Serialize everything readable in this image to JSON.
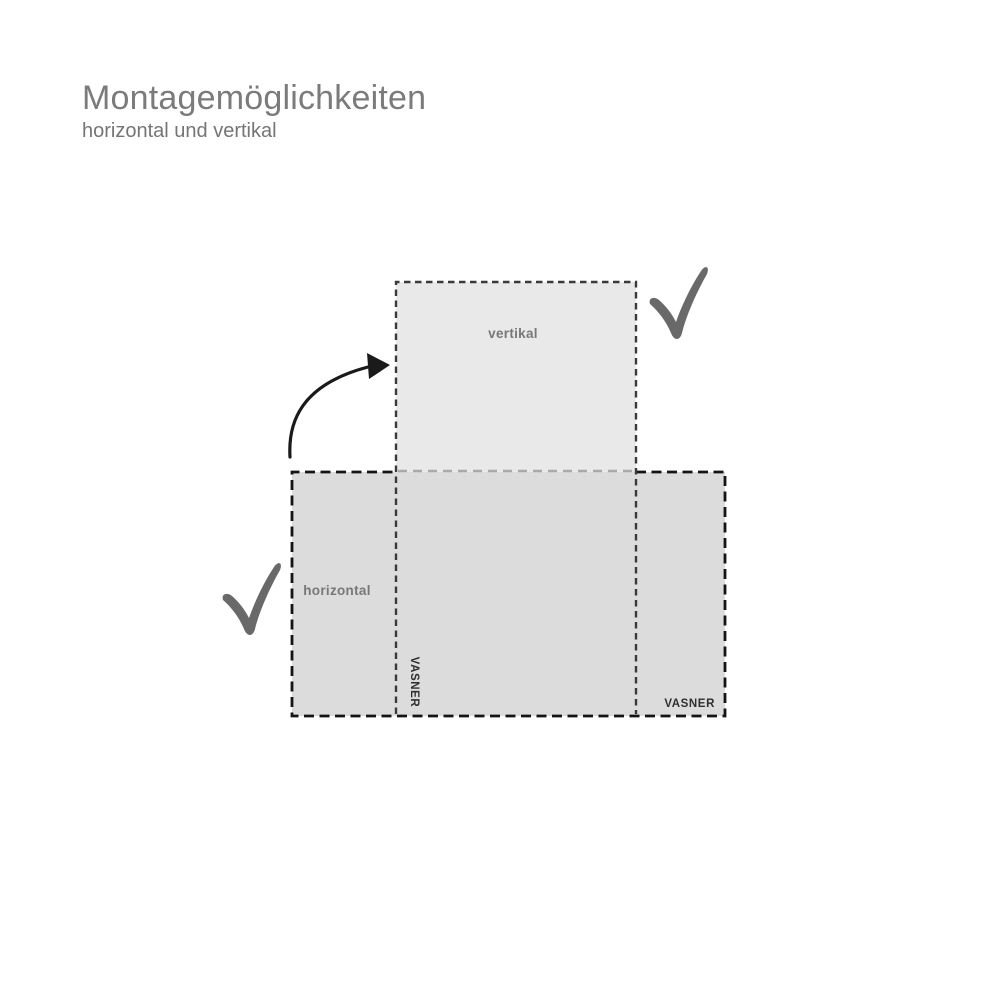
{
  "header": {
    "title": "Montagemöglichkeiten",
    "subtitle": "horizontal und vertikal"
  },
  "diagram": {
    "vertical_panel": {
      "label": "vertikal",
      "brand": "VASNER"
    },
    "horizontal_panel": {
      "label": "horizontal",
      "brand": "VASNER"
    },
    "icons": {
      "vertical_ok": "checkmark-icon",
      "horizontal_ok": "checkmark-icon",
      "rotation": "curved-arrow-icon"
    }
  },
  "colors": {
    "panel_fill_vertical": "#e9e9e9",
    "panel_fill_horizontal": "#dcdcdc",
    "dash_dark": "#141414",
    "dash_medium": "#3a3a3a",
    "dash_light": "#a9a9a9",
    "checkmark": "#696969",
    "arrow": "#1a1a1a",
    "label_gray": "#787878",
    "brand_dark": "#2f2f2f",
    "title_gray": "#7b7b7b"
  }
}
